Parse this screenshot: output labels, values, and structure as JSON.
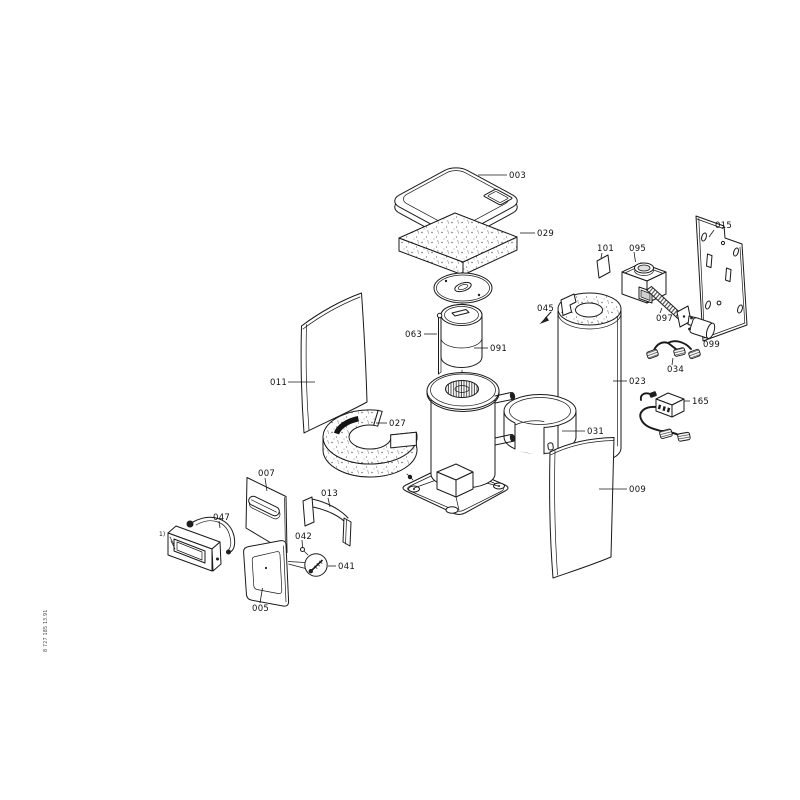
{
  "diagram": {
    "background": "#ffffff",
    "line_color": "#1a1a1a",
    "doc_number": "8 727 185 1",
    "doc_revision": "3.91",
    "footnote_marker": "1)"
  },
  "callouts": {
    "c003": "003",
    "c005": "005",
    "c007": "007",
    "c009": "009",
    "c011": "011",
    "c013": "013",
    "c015": "015",
    "c023": "023",
    "c027": "027",
    "c029": "029",
    "c031": "031",
    "c034": "034",
    "c041": "041",
    "c042": "042",
    "c045": "045",
    "c047": "047",
    "c063": "063",
    "c091": "091",
    "c095": "095",
    "c097": "097",
    "c099": "099",
    "c101": "101",
    "c165": "165"
  }
}
